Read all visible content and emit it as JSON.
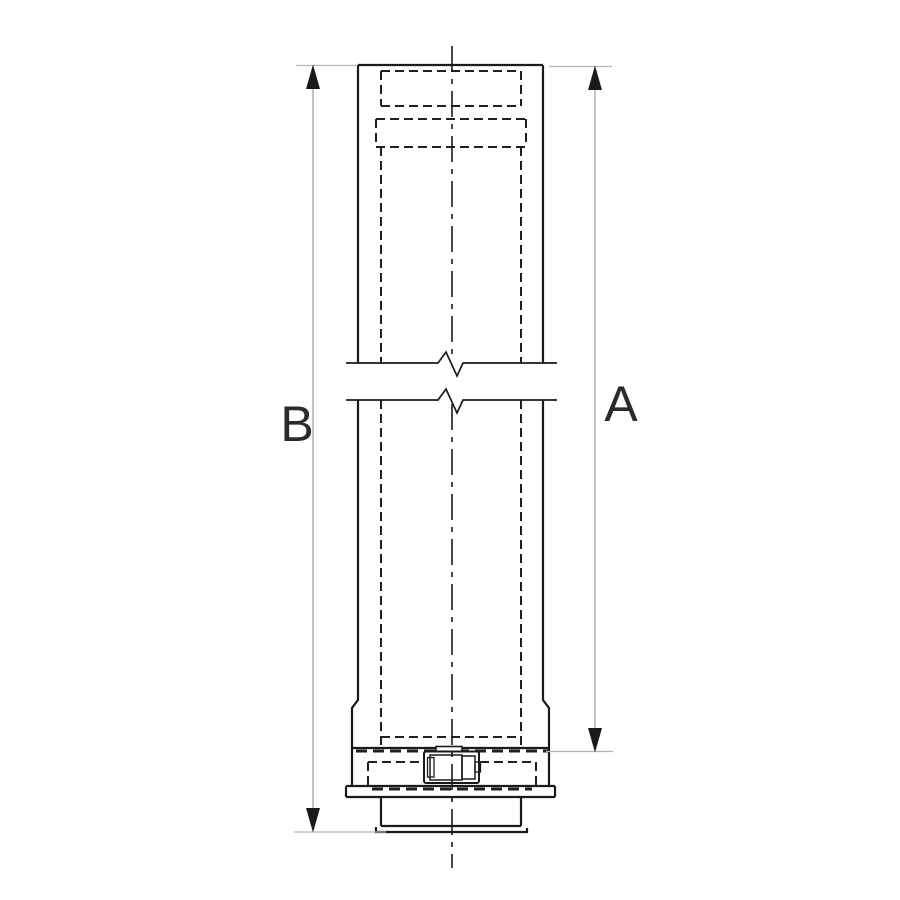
{
  "drawing": {
    "labels": {
      "dim_left": "B",
      "dim_right": "A"
    },
    "colors": {
      "line": "#1a1a1a",
      "hidden_line": "#1f1f1f",
      "dimension_line": "#9c9c9c",
      "extension_line": "#b3b3b3",
      "arrow": "#1a1a1a",
      "label_text": "#2b2b2b",
      "background": "#ffffff"
    }
  }
}
